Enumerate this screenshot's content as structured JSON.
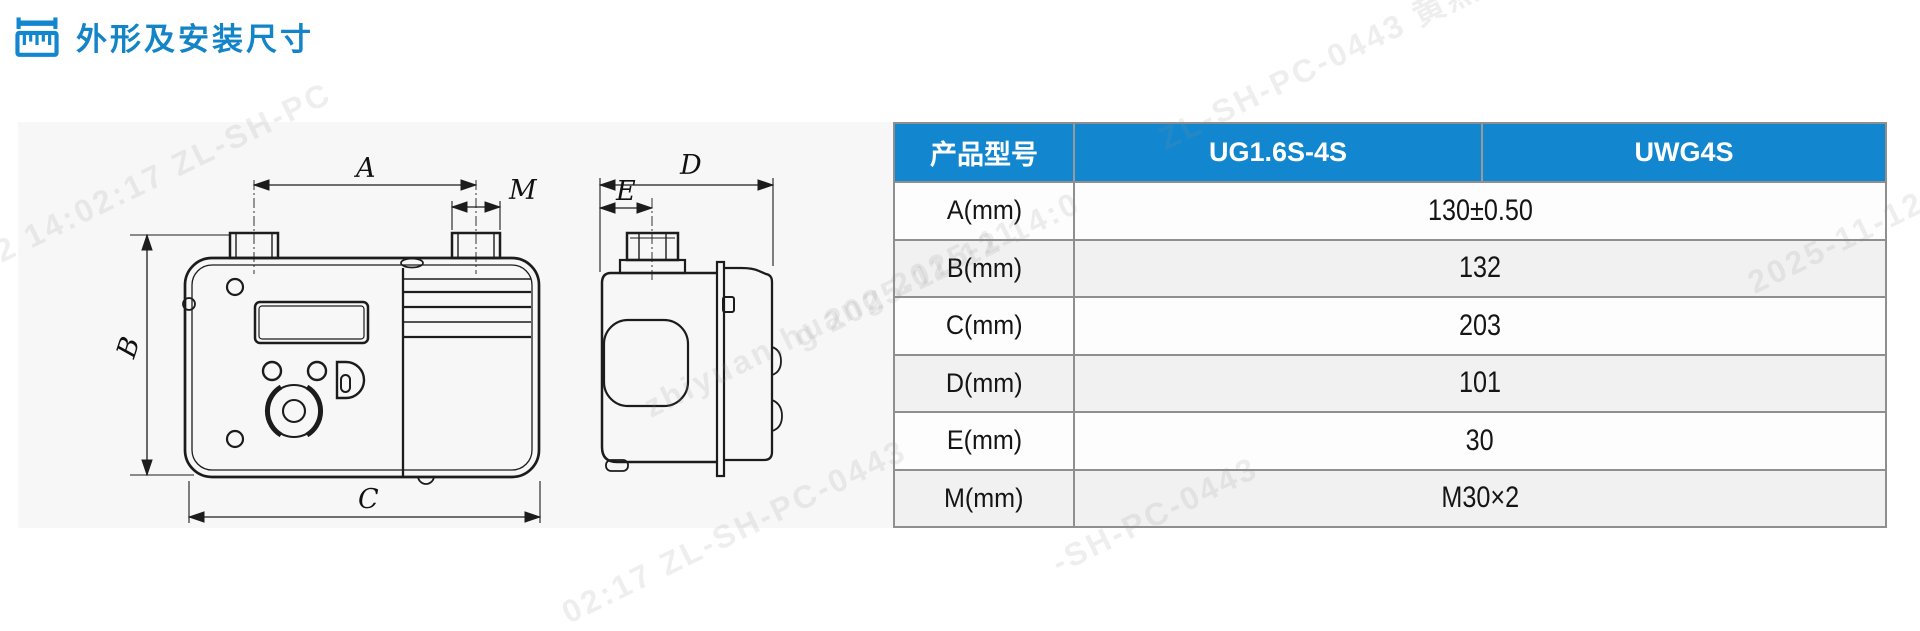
{
  "page": {
    "title": "外形及安装尺寸"
  },
  "colors": {
    "accent_blue": "#1287cf",
    "title_blue": "#1384c8",
    "panel_gray": "#f7f7f7",
    "row_alt_gray": "#f1f1f1",
    "border_gray": "#8f8f8f"
  },
  "table": {
    "columns": [
      "产品型号",
      "UG1.6S-4S",
      "UWG4S"
    ],
    "rows": [
      {
        "label": "A(mm)",
        "value": "130±0.50"
      },
      {
        "label": "B(mm)",
        "value": "132"
      },
      {
        "label": "C(mm)",
        "value": "203"
      },
      {
        "label": "D(mm)",
        "value": "101"
      },
      {
        "label": "E(mm)",
        "value": "30"
      },
      {
        "label": "M(mm)",
        "value": "M30×2"
      }
    ]
  },
  "drawing": {
    "labels": {
      "A": "A",
      "M": "M",
      "B": "B",
      "C": "C",
      "D": "D",
      "E": "E"
    },
    "views": [
      "meter-front-view",
      "meter-side-view"
    ]
  },
  "watermarks": [
    {
      "text": "-12 14:02:17 ZL-SH-PC"
    },
    {
      "text": "ZL-SH-PC-0443 黄燕"
    },
    {
      "text": "zhiyuan.huang 2025-11"
    },
    {
      "text": "2025-11-12"
    },
    {
      "text": "02:17 ZL-SH-PC-0443"
    },
    {
      "text": "-SH-PC-0443"
    },
    {
      "text": "g 2025-11-12 14:0"
    }
  ]
}
